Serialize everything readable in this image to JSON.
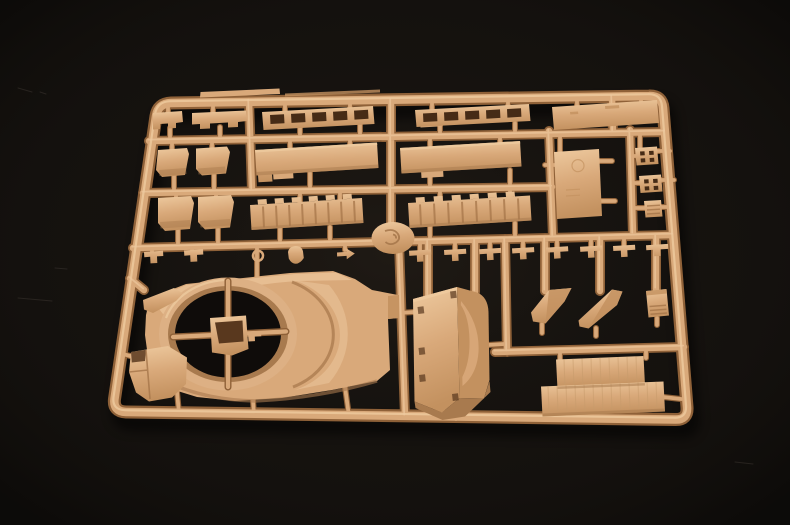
{
  "scene": {
    "subject": "tan plastic model kit sprue (injection-molded parts tree) photographed on a black background",
    "background_color": "#14110e",
    "plastic_color": "#d9a97a"
  },
  "palette": {
    "bg": "#14110e",
    "hole": "#0f0c0a",
    "dark": "#8f6138",
    "mid": "#d9a97a",
    "hi": "#eeca9f",
    "low": "#c3915f",
    "shade": "#a87a4e",
    "deep": "#59381e",
    "slot": "#462b16",
    "ring": "#ddb084",
    "line": "#a5764a",
    "tex": "#c79a6c",
    "scratch": "#3b352f"
  },
  "paths": {
    "frame": "M171,103 L649,96 Q662,95.5 663,108 L687,407 Q688,420 675,419.5 L126,412 Q113,411.5 114.5,399 L156,116 Q158,103.5 171,103 Z",
    "runners": "M149,141 L665,132 M143,193 L552,187 M133,248 L673,235 M391,100 L391,243 M399,243 L405,416 M249,101 L252,190 M549,131 L553,237 M612,97 L613,133 M630,130 L633,234 M505,239 L507,352 M495,352 L684,347 M130,278.5 L144,290 M428,241 L428,296 M475,240 L475,292 M545,238 L545,291 M600,237 L600,291 M656,236 L656,289",
    "stems": "M168,104 L168,114 M213,104 L213,114 M285,103 L285,111 M350,102 L350,110 M432,101 L432,109 M508,100 L508,108 M577,101 L577,108 M641,98 L641,104 M170,128 L170,139 M220,127 L220,138 M300,127 L300,136 M360,125 L360,135 M440,124 L440,134 M515,123 L515,132 M172,141 L172,150 M212,140 L212,149 M290,139 L290,147 M350,138 L350,145 M430,137 L430,145 M500,136 L500,143 M560,134 L560,152 M640,133 L640,147 M174,176 L174,192 M214,175 L214,191 M310,173 L310,190 M430,171 L430,189 M510,170 L510,187 M545,165 L557,165 M599,161 L612,161 M601,201 L615,201 M633,156 L638,156 M658,151 L670,151 M634,183 L642,183 M662,180 L674,180 M635,208 L646,208 M661,207 L673,207 M176,193 L176,201 M216,192 L216,200 M300,190 L300,203 M340,189 L340,201 M440,188 L440,201 M510,187 L510,199 M178,230 L178,246 M218,229 L218,245 M280,228 L280,244 M330,227 L330,243 M430,225 L430,240 M515,223 L515,237 M152,248 L152,252.5 M192,247 L192,252 M257,245 L257,277 M295,244.3 L295,248 M345,243.2 L345,250 M420,241.5 L420,250 M455,240.2 L455,249 M490,239.4 L490,248 M523,238.6 L523,248 M557,237.8 L557,247 M591,237 L591,246 M624,236.2 L624,245 M657,235.4 L657,244 M119,353 L134,357 M177,392 L179,413 M253,400 L254,415 M345,387 L349,416 M399,313 L414,312 M455,412 L456,419 M488,345 L504,344 M542,324 L542,333 M596,328 L596,336 M657,318 L657,325 M560,351 L560,360 M646,349 L646,358 M663,397 L681,399",
    "ringcross": "M228,281 L228,387 M173,337 L286,331.5"
  },
  "layers": [
    {
      "name": "background-scratches",
      "d": "M18,298 l34,3 M55,268 l12,1 M18,88 l14,4 M40,92 l6,2 M735,462 l18,2",
      "stroke": "$scratch",
      "w": 1,
      "op": 0.55,
      "cap": "round"
    },
    {
      "name": "sprue-shadow",
      "ref": "frame",
      "stroke": "#000000",
      "w": 16,
      "op": 0.5,
      "filter": "url(#soft)",
      "transform": "translate(5,11)",
      "join": "round"
    },
    {
      "name": "frame-bar-shade",
      "ref": "frame",
      "stroke": "$dark",
      "w": 13,
      "join": "round"
    },
    {
      "name": "runner-shade",
      "ref": "runners",
      "stroke": "$dark",
      "w": 10,
      "cap": "round"
    },
    {
      "name": "stem-shade",
      "ref": "stems",
      "stroke": "$dark",
      "w": 6,
      "cap": "round"
    },
    {
      "name": "frame-bar",
      "ref": "frame",
      "stroke": "$mid",
      "w": 8.5,
      "join": "round"
    },
    {
      "name": "runner-bar",
      "ref": "runners",
      "stroke": "$mid",
      "w": 6.5,
      "cap": "round"
    },
    {
      "name": "stem-bar",
      "ref": "stems",
      "stroke": "$mid",
      "w": 3.8,
      "cap": "round"
    },
    {
      "name": "frame-highlight",
      "ref": "frame",
      "stroke": "$hi",
      "w": 2.2,
      "op": 0.8,
      "transform": "translate(-1,-1.8)",
      "join": "round"
    },
    {
      "name": "runner-highlight",
      "ref": "runners",
      "stroke": "$hi",
      "w": 1.8,
      "op": 0.65,
      "transform": "translate(-0.8,-1.4)",
      "cap": "round"
    },
    {
      "name": "molding-tab",
      "d": "M200,97.5 L280,94 L279.5,88.5 L200.5,92 Z",
      "fill": "$mid"
    },
    {
      "name": "molding-lip",
      "d": "M285,96.5 L380,92.5 L380,89.5 L285,93.5 Z",
      "fill": "$low",
      "op": 0.8
    },
    {
      "name": "gate-tabs",
      "d": "M272,121 l22,-1.3 l0.5,8 l-22,1.3 Z M420,119.5 l22,-1.3 l0.5,8 l-22,1.3 Z M273,172 l20,-1.2 l0.5,7.5 l-20,1.2 Z M421,170 l22,-1.3 l0.5,8 l-22,1.3 Z",
      "fill": "$mid"
    },
    {
      "name": "part-bracket-a1",
      "d": "M153,113 L182,111 L183,122 L176,123 L176,128 L168,128.5 L168,123.5 L160,124 L160,129 L153,129.5 Z",
      "fill": "url(#gPlastic)"
    },
    {
      "name": "part-bracket-a2",
      "d": "M192,113 L246,110.5 L247,121 L238,122 L238,127 L228,127.5 L228,122.5 L210,123.5 L210,128.5 L200,129 L200,124 L192,124.5 Z",
      "fill": "url(#gPlastic)"
    },
    {
      "name": "part-ladder-a3",
      "d": "M262,112 L373,106 L374.5,124 L263.5,130 Z",
      "fill": "url(#gPlastic)"
    },
    {
      "name": "part-ladder-a3-slots",
      "d": "M270,115 l14,-0.8 l0.5,9 l-14,0.8 Z M291,113.9 l14,-0.8 l0.5,9 l-14,0.8 Z M312,112.8 l14,-0.8 l0.5,9 l-14,0.8 Z M333,111.7 l14,-0.8 l0.5,9 l-14,0.8 Z M354,110.6 l14,-0.8 l0.5,9 l-14,0.8 Z",
      "fill": "$slot"
    },
    {
      "name": "part-ladder-a4",
      "d": "M415,110 L529,104 L530.5,121 L416.5,127 Z",
      "fill": "url(#gPlastic)"
    },
    {
      "name": "part-ladder-a4-slots",
      "d": "M423,113.5 l14,-0.8 l0.4,8.5 l-14,0.8 Z M444,112.4 l14,-0.8 l0.4,8.5 l-14,0.8 Z M465,111.3 l14,-0.8 l0.4,8.5 l-14,0.8 Z M486,110.2 l14,-0.8 l0.4,8.5 l-14,0.8 Z M507,109.1 l14,-0.8 l0.4,8.5 l-14,0.8 Z",
      "fill": "$slot"
    },
    {
      "name": "part-plate-a5",
      "d": "M552,107 L657,100 L659,123 L554,130 Z",
      "fill": "url(#gPlastic)"
    },
    {
      "name": "part-plate-a5-mark",
      "d": "M605,106 l14,-0.9 l0.3,3 l-14,0.9 Z M570,112 l8,-0.5 l0.3,2.5 l-8,0.5 Z",
      "fill": "$low",
      "op": 0.8
    },
    {
      "name": "part-box-b1",
      "d": "M158,150 L187,148 L189,154 L185,175 L162,177 L156,170 Z",
      "fill": "url(#gPlastic)"
    },
    {
      "name": "part-box-b2",
      "d": "M196,148.5 L227,146.5 L230,152 L226,173.5 L202,175.5 L196,169 Z",
      "fill": "url(#gPlastic)"
    },
    {
      "name": "rowB-box-shading",
      "d": "M159,170 l27,-2 l0.5,6 l-27,2 Z M198,168.5 l27,-2 l0.5,6 l-27,2 Z",
      "fill": "$shade",
      "op": 0.45
    },
    {
      "name": "part-plate-b3",
      "d": "M255,150 L377,142.5 L378.5,168 L256.5,175.5 Z M258,175 L272,174.2 L272.5,181.5 L258.5,182.3 Z",
      "fill": "url(#gPlastic)"
    },
    {
      "name": "part-plate-b4",
      "d": "M400,148 L520,141 L521.5,166.5 L401.5,173.5 Z",
      "fill": "url(#gPlastic)"
    },
    {
      "name": "plate-edge-highlights",
      "d": "M255,150 L377,142.5 l0.3,2.5 l-122,7.5 Z M400,148 L520,141 l0.3,2.5 l-120,7 Z",
      "fill": "$hi",
      "op": 0.8
    },
    {
      "name": "plate-edge-shades",
      "d": "M256.5,175.5 L378.5,168 l-0.4,-3.5 l-122,7.5 Z M401.5,173.5 L521.5,166.5 l-0.4,-3.5 l-120,7 Z",
      "fill": "$shade",
      "op": 0.5
    },
    {
      "name": "part-plate-b5",
      "d": "M554,152 L599,149 L602,216 L557,219 Z",
      "fill": "url(#gPlastic)"
    },
    {
      "name": "part-plate-b5-detail",
      "d": "M572,166 a6,6 0 1 0 12,-0.7 a6,6 0 1 0 -12,0.7 Z M566,190 l14,-0.8 M566,196 l14,-0.8",
      "stroke": "$low",
      "w": 1.2,
      "op": 0.7
    },
    {
      "name": "part-square-b6a",
      "d": "M635,148 L657,146.5 L658.5,164 L636.5,165.5 Z",
      "fill": "url(#gPlastic)"
    },
    {
      "name": "part-square-b6a-holes",
      "d": "M640,151.5 l4.5,-0.3 l0.3,4 l-4.5,0.3 Z M649,151 l4.5,-0.3 l0.3,4 l-4.5,0.3 Z M640.6,158.5 l4.5,-0.3 l0.3,4 l-4.5,0.3 Z M649.6,158 l4.5,-0.3 l0.3,4 l-4.5,0.3 Z",
      "fill": "$slot"
    },
    {
      "name": "part-square-b6b",
      "d": "M639,176 L661,174.5 L662.5,191.5 L640.5,193 Z",
      "fill": "url(#gPlastic)"
    },
    {
      "name": "part-square-b6b-holes",
      "d": "M644,179.5 l4.5,-0.3 l0.3,4 l-4.5,0.3 Z M653,179 l4.5,-0.3 l0.3,4 l-4.5,0.3 Z M644.6,186.5 l4.5,-0.3 l0.3,4 l-4.5,0.3 Z M653.6,186 l4.5,-0.3 l0.3,4 l-4.5,0.3 Z",
      "fill": "$slot"
    },
    {
      "name": "part-block-b7",
      "d": "M644,201 L661,200 L662.5,216.5 L645.5,217.5 Z",
      "fill": "url(#gPlastic)"
    },
    {
      "name": "part-block-b7-hatch",
      "d": "M647,206 l13,-0.8 M647,210 l13,-0.8 M647,214 l13,-0.8",
      "stroke": "$line",
      "w": 1.4,
      "op": 0.8
    },
    {
      "name": "part-box-c1",
      "d": "M158,198 L191,196 L194,203 L190,229 L165,231 L158,223 Z",
      "fill": "url(#gPlastic)"
    },
    {
      "name": "part-box-c2",
      "d": "M198,197 L231,195 L234,202 L230,227.5 L205,229.5 L198,222 Z",
      "fill": "url(#gPlastic)"
    },
    {
      "name": "rowC-box-shading",
      "d": "M160,222 l30,-2 l0.5,6.5 l-30,2 Z M200,221 l30,-2 l0.5,6.5 l-30,2 Z",
      "fill": "$shade",
      "op": 0.45
    },
    {
      "name": "part-strip-c3",
      "d": "M250,205 L362,198 L363.5,223 L251.5,230 Z M258,204.6 l9,-0.55 l-0.5,-5 l-9,0.55 Z M275,203.5 l9,-0.55 l-0.5,-5 l-9,0.55 Z M292,202.5 l9,-0.55 l-0.5,-5 l-9,0.55 Z M309,201.4 l9,-0.55 l-0.5,-5 l-9,0.55 Z M326,200.4 l9,-0.55 l-0.5,-5 l-9,0.55 Z M343,199.3 l9,-0.55 l-0.5,-5 l-9,0.55 Z",
      "fill": "url(#gPlastic)"
    },
    {
      "name": "part-strip-c3-ribs",
      "d": "M263,206.5 l1,21 M276,205.7 l1,21 M289,204.9 l1,21 M302,204.1 l1,21 M315,203.3 l1,21 M328,202.5 l1,21 M341,201.7 l1,21 M354,200.9 l1,21",
      "stroke": "$line",
      "w": 2,
      "op": 0.75
    },
    {
      "name": "part-strip-c4",
      "d": "M408,203 L530,195.5 L531.5,220.5 L409.5,228 Z M416,202.5 l9,-0.55 l-0.5,-5 l-9,0.55 Z M434,201.4 l9,-0.55 l-0.5,-5 l-9,0.55 Z M452,200.3 l9,-0.55 l-0.5,-5 l-9,0.55 Z M470,199.2 l9,-0.55 l-0.5,-5 l-9,0.55 Z M488,198.1 l9,-0.55 l-0.5,-5 l-9,0.55 Z M506,197 l9,-0.55 l-0.5,-5 l-9,0.55 Z",
      "fill": "url(#gPlastic)"
    },
    {
      "name": "part-strip-c4-ribs",
      "d": "M420,204.4 l1,21 M434,203.5 l1,21 M448,202.7 l1,21 M462,201.8 l1,21 M476,200.9 l1,21 M490,200.1 l1,21 M504,199.2 l1,21 M518,198.4 l1,21",
      "stroke": "$line",
      "w": 2,
      "op": 0.75
    },
    {
      "name": "strip-bottom-shades",
      "d": "M251.5,230 L363.5,223 l-0.4,-3 l-112,7 Z M409.5,228 L531.5,220.5 l-0.4,-3 l-122,7.5 Z",
      "fill": "$shade",
      "op": 0.5
    },
    {
      "name": "small-parts-left",
      "d": "M144,252 L163,250.8 L163.3,256 L157,256.4 L157.3,263 L150.5,263.4 L150.2,256.8 L144.3,257.2 Z M184,250.5 L203,249.3 L203.3,254.5 L197,254.9 L197.3,261.5 L190.5,261.9 L190.2,255.3 L184.3,255.7 Z M288,252 q1,-5.5 7.5,-6 q6.5,0 7.5,5.5 l0.8,6.5 q-3.5,5.5 -8,5.8 q-4.5,-0.3 -7,-5.2 Z M337,252.5 l9.5,-0.6 l-0.2,-3.4 l8.5,5 l-8,5.8 l-0.2,-3.4 l-9.5,0.6 Z",
      "fill": "url(#gPlastic)"
    },
    {
      "name": "part-ring-eyelet",
      "d": "M253,256 a5,5 0 1 0 10,-0.6 a5,5 0 1 0 -10,0.6 Z",
      "stroke": "$mid",
      "w": 2.5
    },
    {
      "name": "small-parts-right",
      "d": "M409,250.8 l22,-1.3 l0.3,5 l-8,0.5 l0.35,6.5 l-6.5,0.4 l-0.35,-6.5 l-7.5,0.45 Z M444,250 l22,-1.3 l0.3,5 l-8,0.5 l0.35,6.5 l-6.5,0.4 l-0.35,-6.5 l-7.5,0.45 Z M479,249.2 l22,-1.3 l0.3,5 l-8,0.5 l0.35,6.5 l-6.5,0.4 l-0.35,-6.5 l-7.5,0.45 Z M512,248.4 l22,-1.3 l0.3,5 l-8,0.5 l0.35,6.5 l-6.5,0.4 l-0.35,-6.5 l-7.5,0.45 Z M546,247.6 l22,-1.3 l0.3,5 l-8,0.5 l0.35,6.5 l-6.5,0.4 l-0.35,-6.5 l-7.5,0.45 Z M580,246.8 l22,-1.3 l0.3,5 l-8,0.5 l0.35,6.5 l-6.5,0.4 l-0.35,-6.5 l-7.5,0.45 Z M613,246 l22,-1.3 l0.3,5 l-8,0.5 l0.35,6.5 l-6.5,0.4 l-0.35,-6.5 l-7.5,0.45 Z M646,245.2 l22,-1.3 l0.3,5 l-8,0.5 l0.35,6.5 l-6.5,0.4 l-0.35,-6.5 l-7.5,0.45 Z",
      "fill": "url(#gPlastic)"
    },
    {
      "name": "sprue-disc",
      "d": "M371.5,238 a21.5,16 0 1 0 43,0 a21.5,16 0 1 0 -43,0 Z",
      "fill": "url(#gPlastic)"
    },
    {
      "name": "sprue-disc-mark",
      "d": "M385,231 q9,-3 13,3 q3,5 -2,8.5 q-6,3.5 -10.5,-0.5 M393,234.5 q3.5,0.5 3,4",
      "stroke": "$line",
      "w": 1.8,
      "op": 0.85
    },
    {
      "name": "part-hull-main",
      "d": "M150,298 L186,284 L290,273 L333,271 L355,279 L372,290 L398,295 L399,318 L388,319 L390,370 L377,381 L332,390 L282,398 L235,401 L197,397 L171,389 L156,377 L148,357 L145,335 L146,315 Z",
      "fill": "$mid"
    },
    {
      "name": "hull-top-facet",
      "d": "M152,300 L186,285 L295,274 L336,272.5 L352,280 L300,281 Q240,284 196,303 L163,314 Z",
      "fill": "$hi",
      "op": 0.65
    },
    {
      "name": "hull-crescent",
      "d": "M293,280 a72,59 0 0 1 2,110 l34,-7 a100,84 0 0 0 0,-98 Z",
      "fill": "$hi",
      "op": 0.5
    },
    {
      "name": "hull-crescent-shadow",
      "d": "M292,282 a71,58 0 0 1 1,105",
      "stroke": "$shade",
      "w": 3,
      "op": 0.75
    },
    {
      "name": "hull-right-step",
      "d": "M388,296 L399,295 L399,318 L388,319 Z",
      "fill": "$low",
      "op": 0.9
    },
    {
      "name": "hull-bottom-shade",
      "d": "M156,377 Q200,400 255,401 Q320,398 377,381",
      "stroke": "$shade",
      "w": 3.5,
      "op": 0.6
    },
    {
      "name": "turret-ring-outer",
      "d": "M159,334 a69,56.5 0 1 0 138,0 a69,56.5 0 1 0 -138,0 Z",
      "fill": "$ring"
    },
    {
      "name": "turret-ring-inner-wall",
      "d": "M168,334 a60,48 0 1 0 120,0 a60,48 0 1 0 -120,0 Z",
      "fill": "$shade"
    },
    {
      "name": "turret-ring-hole",
      "d": "M175,334 a53,43.5 0 1 0 106,0 a53,43.5 0 1 0 -106,0 Z",
      "fill": "$hole"
    },
    {
      "name": "turret-ring-highlight",
      "d": "M166,318 a66,54 0 0 1 58,-38",
      "stroke": "$hi",
      "w": 2.2,
      "op": 0.8
    },
    {
      "name": "ring-cross-runner-shade",
      "ref": "ringcross",
      "stroke": "$dark",
      "w": 7,
      "cap": "round"
    },
    {
      "name": "ring-cross-runner",
      "ref": "ringcross",
      "stroke": "$mid",
      "w": 4.2,
      "cap": "round"
    },
    {
      "name": "part-basket",
      "d": "M210,318 L246,315.5 L248.5,349 L232,355.5 L212,352.5 Z",
      "fill": "url(#gPlastic)"
    },
    {
      "name": "part-basket-opening",
      "d": "M215,322.5 L242.5,320.5 L243.5,341.5 L219,343.5 Z",
      "fill": "$deep"
    },
    {
      "name": "part-basket-bracket",
      "d": "M248,332.5 l13,-0.8 l0.3,4.5 l-6.5,0.4 l0.2,4.5 l-6.5,0.4 Z",
      "fill": "$mid"
    },
    {
      "name": "part-wing1",
      "d": "M143,300 L174,288 L183,293.5 L176,301 L153,313 L144,309.5 Z",
      "fill": "url(#gPlastic)"
    },
    {
      "name": "part-wing2",
      "d": "M131,352 L168,346 L187,357.5 L186,384 L172,397.5 L149,401.5 L136,392.5 L129,372 Z",
      "fill": "url(#gPlastic)"
    },
    {
      "name": "part-wing2-notch",
      "d": "M131,352 L146,349.8 L145,361 L131.8,362.5 Z",
      "fill": "$deep",
      "op": 0.85
    },
    {
      "name": "part-wing2-folds",
      "d": "M146,350 L150,399 M129,372 L148,370",
      "stroke": "$line",
      "w": 1.6,
      "op": 0.8
    },
    {
      "name": "part-bigbox-left-face",
      "d": "M413,299 L457,287 L459.5,398 L442,412.5 L414.5,401.5 Z",
      "fill": "url(#gPlastic)"
    },
    {
      "name": "part-bigbox-top-edge",
      "d": "M413,299 L457,287 l0.3,3 l-43.7,12.3 Z",
      "fill": "$hi",
      "op": 0.85
    },
    {
      "name": "part-bigbox-right-face",
      "d": "M457,287 L477,292.5 Q488,297 488.5,312 L489.5,380 L484,398.5 L459.5,398 Z",
      "fill": "$low"
    },
    {
      "name": "part-bigbox-bulge",
      "d": "M461,301 Q480,324 478.5,352 Q477,374 462.5,386 L462.3,377 Q470,362 469.5,340 Q469,317 460.8,305 Z",
      "fill": "$mid",
      "op": 0.9
    },
    {
      "name": "part-bigbox-skirt",
      "d": "M414.5,401.5 L442,412.5 L459.5,398 L484,398.5 L489.5,381 L490.5,392 L465,416.5 L442.5,420 L415.5,408 Z",
      "fill": "$shade"
    },
    {
      "name": "part-bigbox-latches",
      "d": "M417.5,307 l6,-0.8 l0.8,7 l-6,0.8 Z M418.5,348 l6,-0.8 l0.8,7 l-6,0.8 Z M419,375 l6,-0.8 l0.8,7 l-6,0.8 Z M450,291.5 l6,-0.8 l0.8,7 l-6,0.8 Z M452,394 l6,-0.8 l0.8,7 l-6,0.8 Z",
      "fill": "$deep",
      "op": 0.7
    },
    {
      "name": "part-wedge1",
      "d": "M531,312.5 L549,290 L571.5,288 L564.5,301.5 L545.5,323.5 L533,321.5 Z",
      "fill": "url(#gPlastic)"
    },
    {
      "name": "part-wedge1-face",
      "d": "M549,290 L571.5,288 L564.5,301.5 L545.5,323.5 Z",
      "fill": "$low",
      "op": 0.85
    },
    {
      "name": "part-wedge2",
      "d": "M578.5,320.5 L612,289.5 L622.5,291.5 L617,305 L588.5,328.5 L579.5,326.5 Z",
      "fill": "url(#gPlastic)"
    },
    {
      "name": "part-wedge2-face",
      "d": "M612,289.5 L622.5,291.5 L617,305 L588.5,328.5 Z",
      "fill": "$low",
      "op": 0.85
    },
    {
      "name": "part-block2",
      "d": "M646,291 L666.5,289 L669,315.5 L648.5,317.5 Z",
      "fill": "url(#gPlastic)"
    },
    {
      "name": "part-block2-top",
      "d": "M646,291 L666.5,289 l0.4,4.5 l-20.5,2 Z",
      "fill": "$low",
      "op": 0.8
    },
    {
      "name": "part-block2-hatch",
      "d": "M649.5,306.5 l16.5,-1.3 M650,310.5 l16.5,-1.3 M650.5,314.3 l16.5,-1.3",
      "stroke": "$line",
      "w": 1.5,
      "op": 0.8
    },
    {
      "name": "part-plateBR-upper",
      "d": "M556,359.5 L643.5,356 L645,385.5 L557.5,389 Z",
      "fill": "url(#gPlastic)"
    },
    {
      "name": "part-plateBR-lower",
      "d": "M541,386.5 L663.5,381.5 L665,411.5 L542.5,416.5 Z",
      "fill": "url(#gPlastic)"
    },
    {
      "name": "part-plateBR-texture",
      "d": "M564,359.2 l0.9,26 M573,358.8 l0.9,26 M582,358.5 l0.9,26 M591,358.1 l0.9,26 M600,357.7 l0.9,26 M609,357.4 l0.9,26 M618,357 l0.9,26 M627,356.6 l0.9,26 M636,356.3 l0.9,26 M548,386.2 l1,26 M557,385.8 l1,26 M566,385.5 l1,26 M575,385.1 l1,26 M584,384.7 l1,26 M593,384.4 l1,26 M602,384 l1,26 M611,383.6 l1,26 M620,383.3 l1,26 M629,382.9 l1,26 M638,382.5 l1,26 M647,382.2 l1,26 M656,381.8 l1,26",
      "stroke": "$tex",
      "w": 1,
      "op": 0.55
    },
    {
      "name": "part-plateBR-seams",
      "d": "M557.5,389 L645,385.5 l-0.2,-2.5 l-87.3,3.5 Z M542.5,416.5 L665,411.5 l-0.2,-3 l-122.3,5 Z",
      "fill": "$shade",
      "op": 0.55
    }
  ]
}
